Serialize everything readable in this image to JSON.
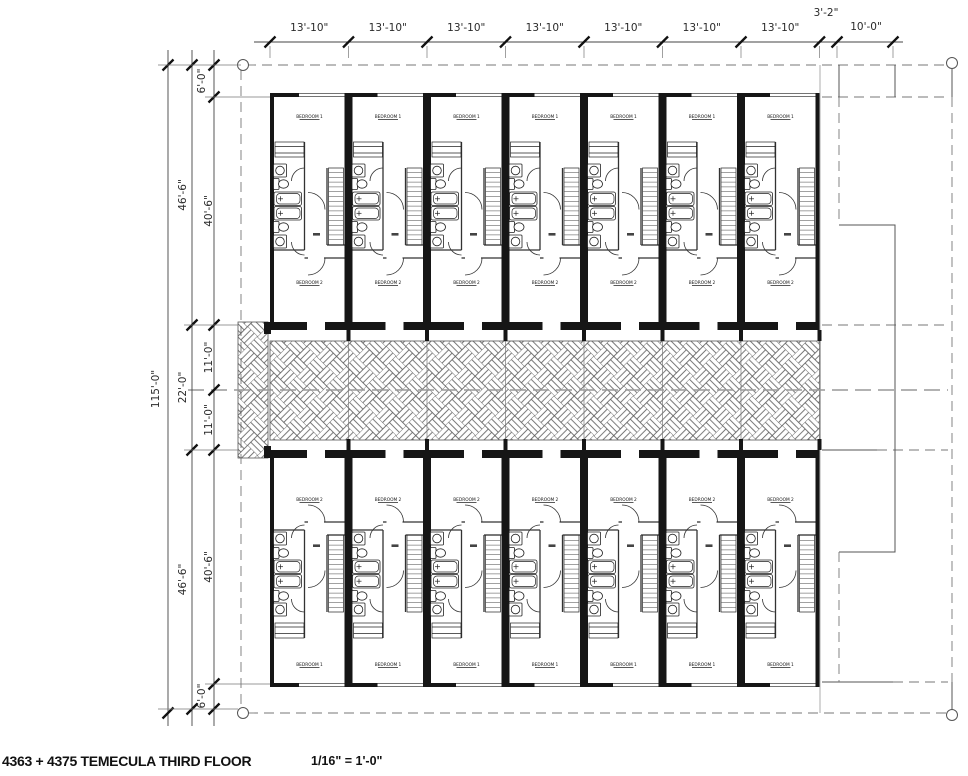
{
  "title_block": {
    "title": "4363 + 4375 TEMECULA THIRD FLOOR",
    "scale": "1/16\" = 1'-0\""
  },
  "dimensions": {
    "top": {
      "bay_width": "13'-10\"",
      "bay_count": 7,
      "offset": "3'-2\"",
      "right_bay": "10'-0\""
    },
    "left": {
      "overall": "115'-0\"",
      "wing": "46'-6\"",
      "unit_depth": "40'-6\"",
      "edge": "6'-0\"",
      "corridor": "22'-0\"",
      "corridor_half": "11'-0\""
    }
  },
  "unit_labels": {
    "bedroom1": "BEDROOM 1",
    "bedroom2": "BEDROOM 2"
  },
  "layout": {
    "units_per_row": 7,
    "rows": 2
  },
  "colors": {
    "line_dark": "#161616",
    "line_mid": "#555555",
    "line_light": "#999999",
    "background": "#ffffff"
  }
}
